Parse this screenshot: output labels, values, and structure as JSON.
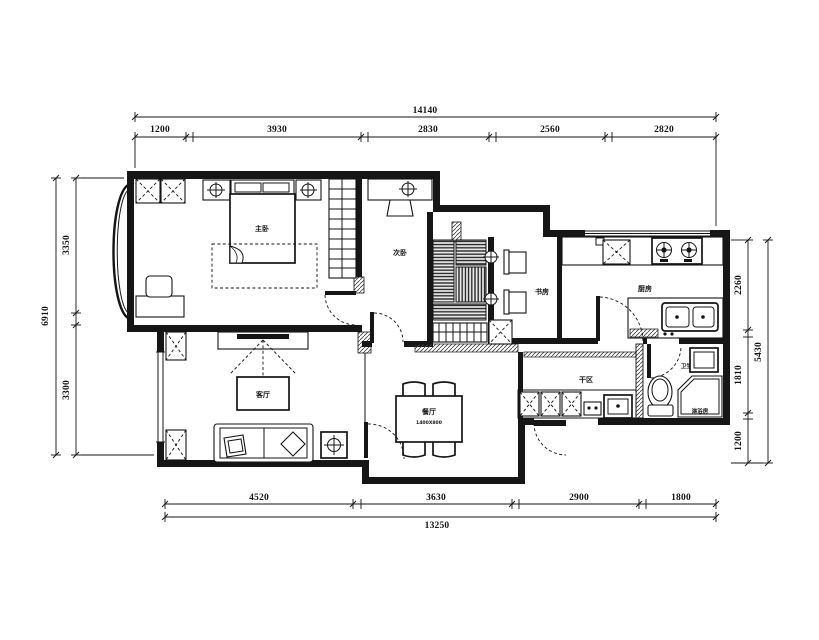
{
  "drawing": {
    "type": "apartment floor plan",
    "line_color": "#141414",
    "background": "#ffffff"
  },
  "dimensions": {
    "top": {
      "total": "14140",
      "segments": [
        "1200",
        "3930",
        "2830",
        "2560",
        "2820"
      ]
    },
    "bottom": {
      "total": "13250",
      "segments": [
        "4520",
        "3630",
        "2900",
        "1800"
      ]
    },
    "left": {
      "total": "6910",
      "segments": [
        "3350",
        "3300"
      ]
    },
    "right": {
      "total": "5430",
      "segments": [
        "2260",
        "1810",
        "1200"
      ]
    }
  },
  "rooms": {
    "master_bedroom": "主卧",
    "second_bedroom": "次卧",
    "study": "书房",
    "kitchen": "厨房",
    "living_room": "客厅",
    "dining_room": "餐厅",
    "dining_note": "1400X800",
    "dry_area": "干区",
    "bathroom": "卫生间",
    "shower": "淋浴房"
  }
}
